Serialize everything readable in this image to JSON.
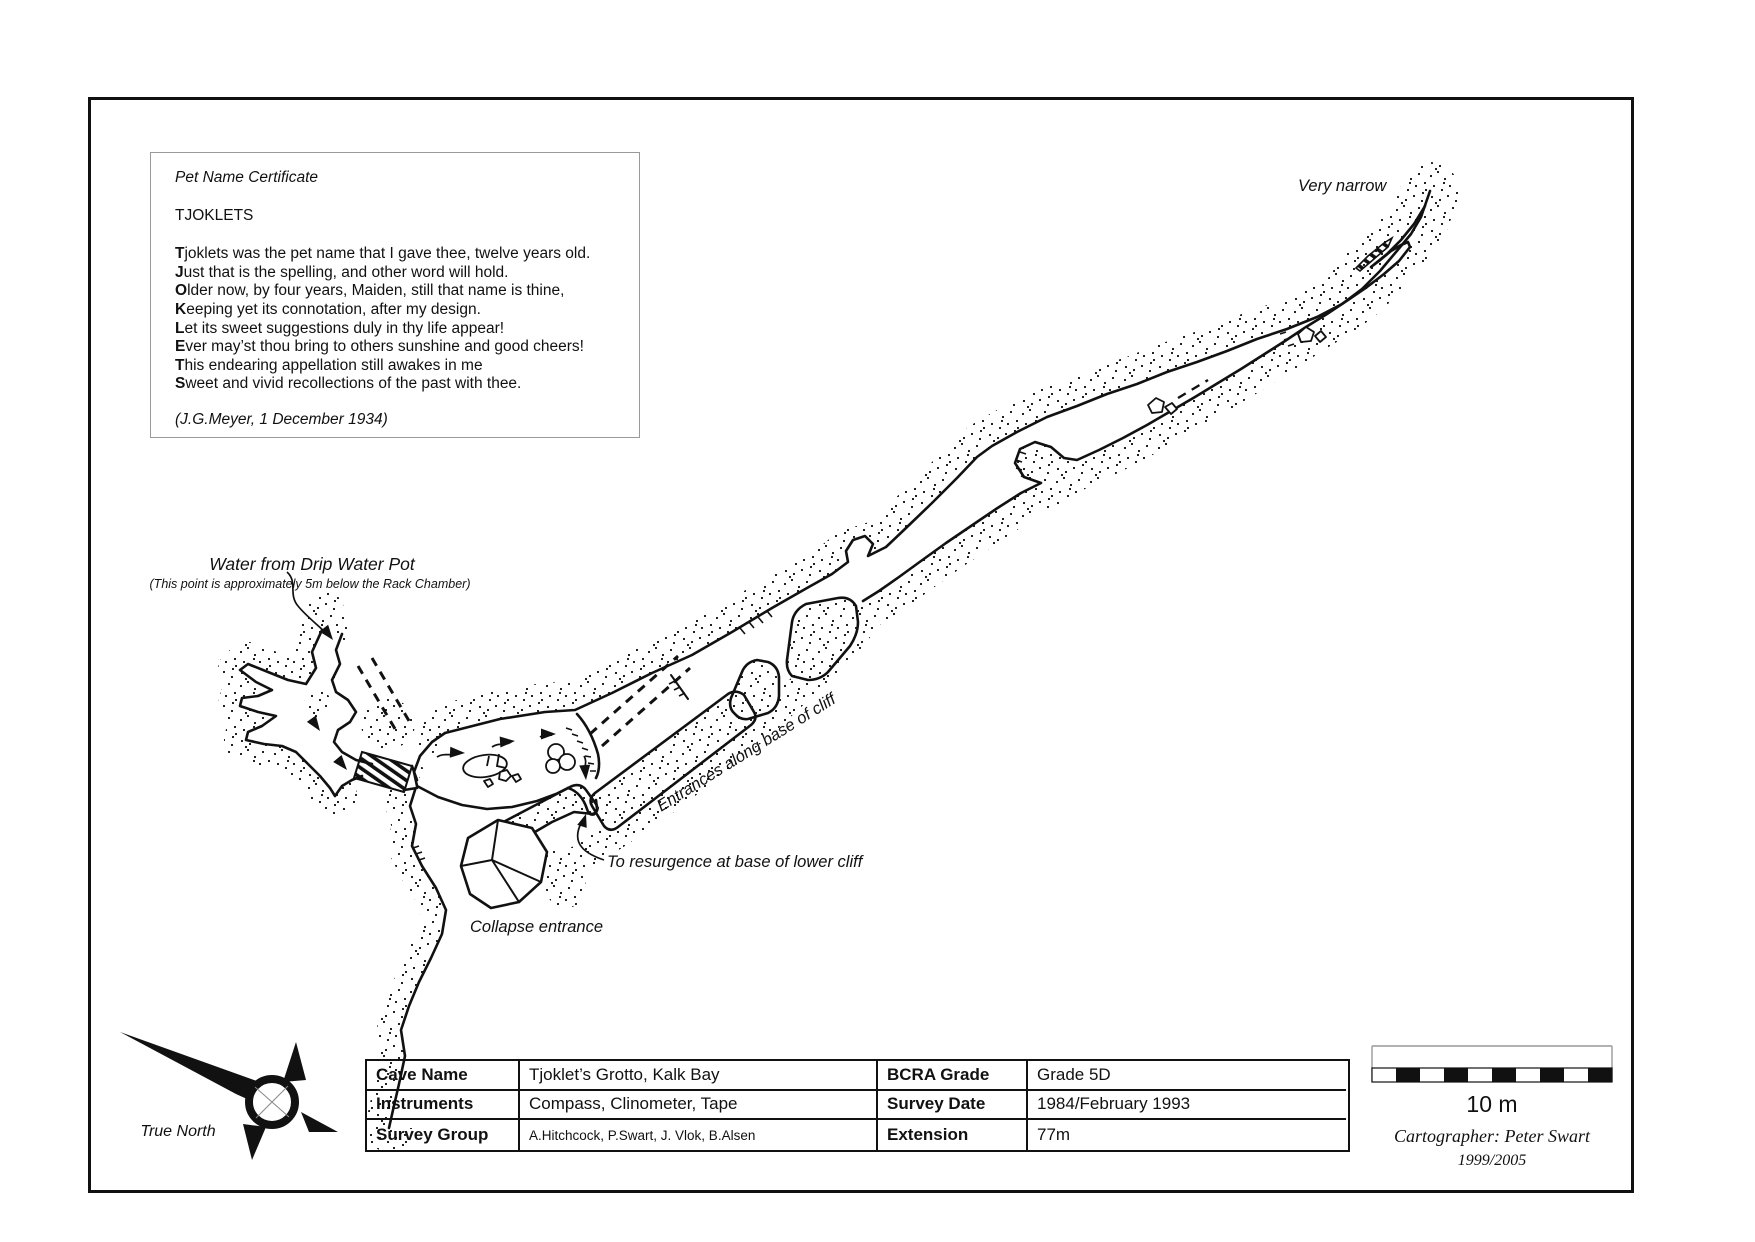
{
  "poem_box": {
    "title": "Pet Name Certificate",
    "name": "TJOKLETS",
    "lines": [
      {
        "bold": "T",
        "rest": "joklets was the pet name that I gave thee, twelve years old."
      },
      {
        "bold": "J",
        "rest": "ust that is the spelling, and other word will hold."
      },
      {
        "bold": "O",
        "rest": "lder now, by four years, Maiden, still that name is thine,"
      },
      {
        "bold": "K",
        "rest": "eeping yet its connotation, after my design."
      },
      {
        "bold": "L",
        "rest": "et its sweet suggestions duly in thy life appear!"
      },
      {
        "bold": "E",
        "rest": "ver may’st thou bring to others sunshine and good cheers!"
      },
      {
        "bold": "T",
        "rest": "his endearing appellation still awakes in me"
      },
      {
        "bold": "S",
        "rest": "weet and vivid recollections of the past with thee."
      }
    ],
    "attribution": "(J.G.Meyer, 1 December 1934)"
  },
  "map_labels": {
    "very_narrow": "Very narrow",
    "water_title": "Water from Drip Water Pot",
    "water_sub": "(This point is approximately 5m below the Rack Chamber)",
    "entrances": "Entrances along base of cliff",
    "resurgence": "To resurgence at base of lower cliff",
    "collapse": "Collapse entrance"
  },
  "compass": {
    "label": "True North"
  },
  "scale_bar": {
    "label": "10 m",
    "cartographer": "Cartographer: Peter Swart",
    "years": "1999/2005"
  },
  "info_table": {
    "rows": [
      {
        "label_left": "Cave Name",
        "value_left": "Tjoklet’s Grotto, Kalk Bay",
        "label_right": "BCRA Grade",
        "value_right": "Grade 5D"
      },
      {
        "label_left": "Instruments",
        "value_left": "Compass, Clinometer, Tape",
        "label_right": "Survey Date",
        "value_right": "1984/February 1993"
      },
      {
        "label_left": "Survey Group",
        "value_left": "A.Hitchcock, P.Swart, J. Vlok, B.Alsen",
        "label_right": "Extension",
        "value_right": "77m"
      }
    ]
  },
  "colors": {
    "ink": "#111111",
    "background": "#ffffff"
  }
}
